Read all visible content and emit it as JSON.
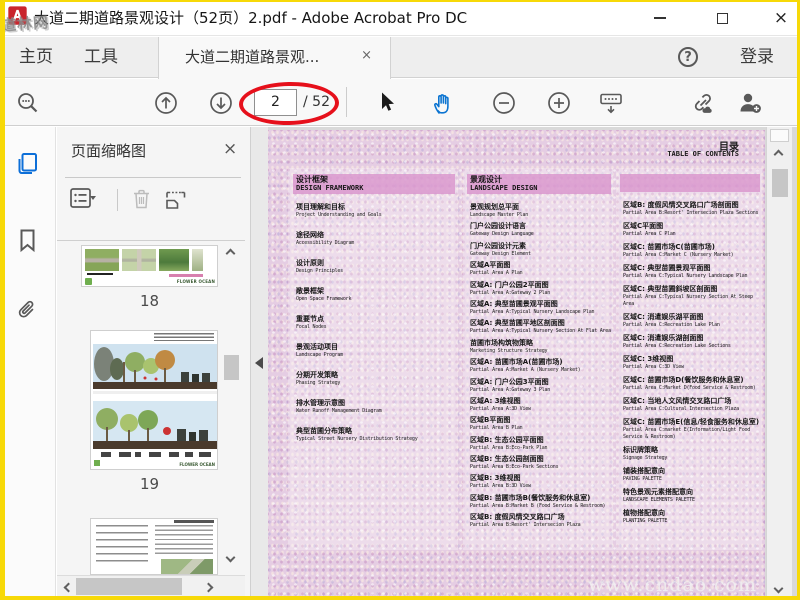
{
  "window": {
    "title": "大道二期道路景观设计（52页）2.pdf - Adobe Acrobat Pro DC",
    "corner_watermark": "道林网"
  },
  "glyphs": {
    "close": "×",
    "help": "?"
  },
  "menubar": {
    "home": "主页",
    "tools": "工具",
    "doc_tab": "大道二期道路景观...",
    "sign_in": "登录"
  },
  "toolbar": {
    "page_current": "2",
    "page_total": "/ 52",
    "annotation_color": "#e6101b"
  },
  "thumbnail_panel": {
    "title": "页面缩略图",
    "page_labels": [
      "18",
      "19"
    ],
    "thumb_brand_text": "FLOWER OCEAN"
  },
  "page": {
    "toc_title_cn": "目录",
    "toc_title_en": "TABLE OF CONTENTS",
    "watermark": "www.cndao.com",
    "columns": [
      {
        "header_cn": "设计框架",
        "header_en": "DESIGN FRAMEWORK",
        "entries": [
          {
            "cn": "项目理解和目标",
            "en": "Project Understanding and Goals"
          },
          {
            "cn": "途径网络",
            "en": "Accessibility Diagram"
          },
          {
            "cn": "设计原则",
            "en": "Design Principles"
          },
          {
            "cn": "敞景框架",
            "en": "Open Space Framework"
          },
          {
            "cn": "重要节点",
            "en": "Focal Nodes"
          },
          {
            "cn": "景观活动项目",
            "en": "Landscape Program"
          },
          {
            "cn": "分期开发策略",
            "en": "Phasing Strategy"
          },
          {
            "cn": "排水管理示意图",
            "en": "Water Runoff Management Diagram"
          },
          {
            "cn": "典型苗圃分布策略",
            "en": "Typical Street Nursery Distribution Strategy"
          }
        ]
      },
      {
        "header_cn": "景观设计",
        "header_en": "LANDSCAPE DESIGN",
        "entries": [
          {
            "cn": "景观规划总平面",
            "en": "Landscape Master Plan"
          },
          {
            "cn": "门户公园设计语言",
            "en": "Gateway Design Language"
          },
          {
            "cn": "门户公园设计元素",
            "en": "Gateway Design Element"
          },
          {
            "cn": "区域A平面图",
            "en": "Partial Area A Plan"
          },
          {
            "cn": "区域A: 门户公园2平面图",
            "en": "Partial Area A:Gateway 2 Plan"
          },
          {
            "cn": "区域A: 典型苗圃景观平面图",
            "en": "Partial Area A:Typical Nursery Landscape Plan"
          },
          {
            "cn": "区域A: 典型苗圃平地区剖面图",
            "en": "Partial Area A:Typical Nursery Section At Flat Area"
          },
          {
            "cn": "苗圃市场构筑物策略",
            "en": "Marketing Structure Strategy"
          },
          {
            "cn": "区域A: 苗圃市场A(苗圃市场)",
            "en": "Partial Area A:Market A (Nursery Market)"
          },
          {
            "cn": "区域A: 门户公园3平面图",
            "en": "Partial Area A:Gateway 3 Plan"
          },
          {
            "cn": "区域A: 3维视图",
            "en": "Partial Area A:3D View"
          },
          {
            "cn": "区域B平面图",
            "en": "Partial Area B Plan"
          },
          {
            "cn": "区域B: 生态公园平面图",
            "en": "Partial Area B:Eco-Park Plan"
          },
          {
            "cn": "区域B: 生态公园剖面图",
            "en": "Partial Area B:Eco-Park Sections"
          },
          {
            "cn": "区域B: 3维视图",
            "en": "Partial Area B:3D View"
          },
          {
            "cn": "区域B: 苗圃市场B(餐饮服务和休息室)",
            "en": "Partial Area B:Market B (Food Service & Restroom)"
          },
          {
            "cn": "区域B: 度假风情交叉路口广场",
            "en": "Partial Area B:Resort' Intersecion Plaza"
          }
        ]
      },
      {
        "header_cn": "",
        "header_en": "",
        "entries": [
          {
            "cn": "区域B: 度假风情交叉路口广场剖面图",
            "en": "Partial Area B:Resort' Intersecion Plaza Sections"
          },
          {
            "cn": "区域C平面图",
            "en": "Partial Area C Plan"
          },
          {
            "cn": "区域C: 苗圃市场C(苗圃市场)",
            "en": "Partial Area C:Market C (Nursery Market)"
          },
          {
            "cn": "区域C: 典型苗圃景观平面图",
            "en": "Partial Area C:Typical Nursery Landscape Plan"
          },
          {
            "cn": "区域C: 典型苗圃斜坡区剖面图",
            "en": "Partial Area C:Typical Nursery Section At Steep Area"
          },
          {
            "cn": "区域C: 消遣娱乐湖平面图",
            "en": "Partial Area C:Recreation Lake Plan"
          },
          {
            "cn": "区域C: 消遣娱乐湖剖面图",
            "en": "Partial Area C:Recreation Lake Sections"
          },
          {
            "cn": "区域C: 3维视图",
            "en": "Partial Area C:3D View"
          },
          {
            "cn": "区域C: 苗圃市场D(餐饮服务和休息室)",
            "en": "Partial Area C:Market D(Food Service & Restroom)"
          },
          {
            "cn": "区域C: 当地人文风情交叉路口广场",
            "en": "Partial Area C:Cultural Intersection Plaza"
          },
          {
            "cn": "区域C: 苗圃市场E(信息/轻食服务和休息室)",
            "en": "Partial Area C:market E(Information/Light Food Service & Restroom)"
          },
          {
            "cn": "标识牌策略",
            "en": "Signage Strategy"
          },
          {
            "cn": "铺装搭配意向",
            "en": "PAVING PALETTE"
          },
          {
            "cn": "特色景观元素搭配意向",
            "en": "LANDSCAPE ELEMENTS PALETTE"
          },
          {
            "cn": "植物搭配意向",
            "en": "PLANTING PALETTE"
          }
        ]
      }
    ]
  }
}
